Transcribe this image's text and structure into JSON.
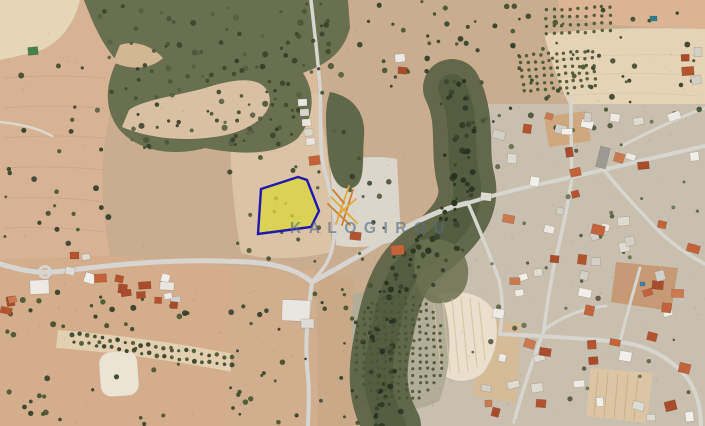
{
  "map": {
    "kind_label": "satellite-aerial-imagery",
    "watermark": {
      "text": "KALOGIROU",
      "text_color": "rgba(86,106,134,0.62)",
      "logo_color_light": "#e3a83d",
      "logo_color_dark": "#cc8030"
    },
    "parcel": {
      "label": "highlighted-land-plot",
      "points": "261,189 298,177 307,180 319,211 311,227 258,234",
      "fill": "#d8d63c",
      "fill_opacity": "0.78",
      "stroke": "#1f18b0",
      "stroke_width": "2.4"
    },
    "palette": {
      "base_tan": "#c9ad8e",
      "field_tan": "#d7b294",
      "field_pink": "#d4ad8c",
      "field_cream": "#e6d6b8",
      "scrub_dark": "#68704f",
      "valley_green": "#5d6446",
      "tree_dark": "#3c4829",
      "road_grey": "#d6d5cf",
      "roof_red": "#bb5b39",
      "roof_white": "#e9e6df",
      "village_ground": "#c9bfae",
      "pad_grey": "#dad6ca",
      "pool_blue": "#3e7fae",
      "pool_green": "#44824a"
    }
  }
}
